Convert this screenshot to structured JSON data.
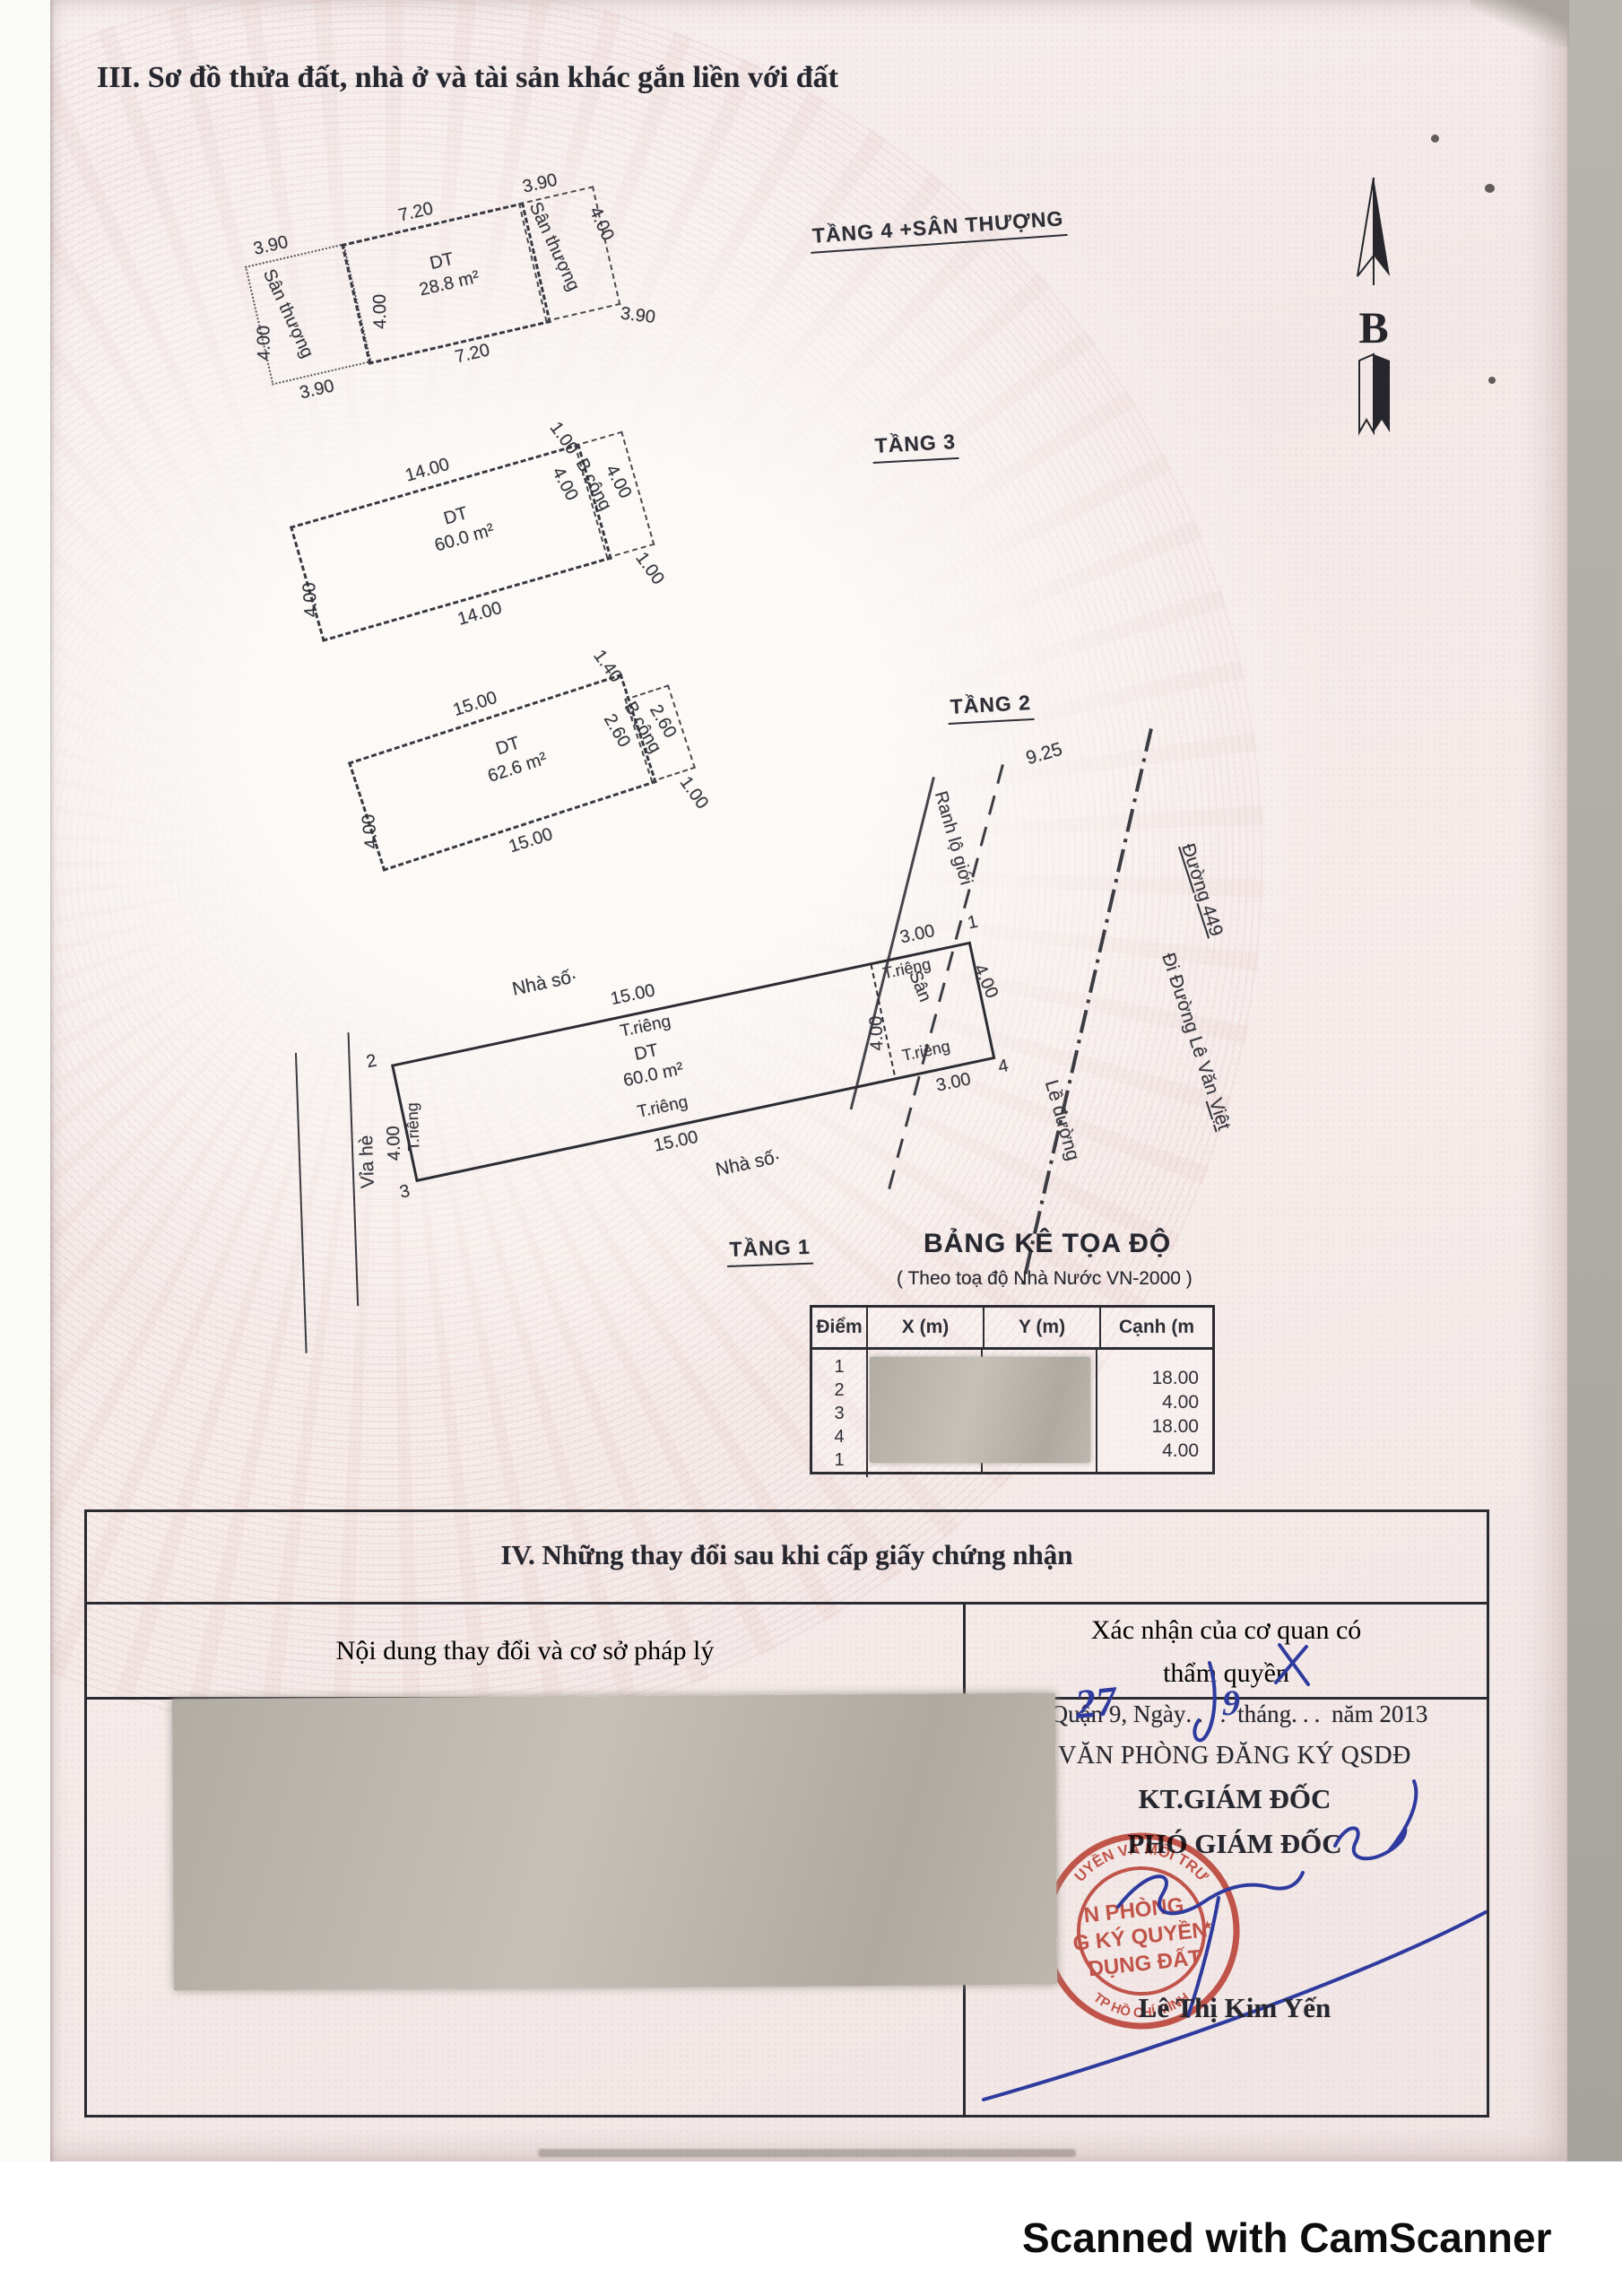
{
  "colors": {
    "stamp_red": "#c0392b",
    "pen_blue": "#2e3a9e"
  },
  "header": {
    "section_title": "III. Sơ đồ thửa đất, nhà ở và tài sản khác gắn liền với đất"
  },
  "compass": {
    "label": "B"
  },
  "plans": {
    "tang4": {
      "floor_label": "TẦNG 4 +SÂN THƯỢNG",
      "dt_label": "DT",
      "area": "28.8 m²",
      "top": "7.20",
      "bottom": "7.20",
      "divider": "4.00",
      "left_annex": {
        "name": "Sân thượng",
        "top": "3.90",
        "side": "4.00",
        "bottom": "3.90"
      },
      "right_annex": {
        "name": "Sân thượng",
        "top": "3.90",
        "side": "4.00",
        "bottom": "3.90"
      }
    },
    "tang3": {
      "floor_label": "TẦNG 3",
      "dt_label": "DT",
      "area": "60.0 m²",
      "top": "14.00",
      "bottom": "14.00",
      "left": "4.00",
      "balcony": {
        "name": "B.công",
        "inner": "4.00",
        "outer": "4.00",
        "tick_top": "1.00",
        "tick_bottom": "1.00"
      }
    },
    "tang2": {
      "floor_label": "TẦNG 2",
      "dt_label": "DT",
      "area": "62.6 m²",
      "top": "15.00",
      "bottom": "15.00",
      "left": "4.00",
      "balcony": {
        "name": "B.công",
        "inner": "2.60",
        "outer": "2.60",
        "tick_top": "1.40",
        "tick_bottom": "1.00"
      }
    },
    "tang1": {
      "floor_label": "TẦNG 1",
      "dt_label": "DT",
      "area": "60.0 m²",
      "house_no_top": "Nhà số·",
      "house_no_bottom": "Nhà số·",
      "top_len": "15.00",
      "top_type": "T.riêng",
      "bottom_type": "T.riêng",
      "bottom_len": "15.00",
      "left_type": "T.riêng",
      "left_len": "4.00",
      "sidewalk": "Vỉa hè",
      "yard": "Sân",
      "yard_top_len": "3.00",
      "yard_top_type": "T.riêng",
      "yard_bottom_type": "T.riêng",
      "yard_bottom_len": "3.00",
      "divider_len": "4.00",
      "right_len": "4.00",
      "v1": "1",
      "v2": "2",
      "v3": "3",
      "v4": "4"
    }
  },
  "roads": {
    "ranh_lo_gioi": "Ranh lộ giới",
    "le_duong": "Lề đường",
    "duong_449": "Đường 449",
    "di_duong_pre": "Đi Đường Lê Văn ",
    "di_duong_underline": "Việt",
    "dim_925": "9.25"
  },
  "coord_table": {
    "title": "BẢNG KÊ TỌA ĐỘ",
    "subtitle": "( Theo toạ độ Nhà Nước VN-2000 )",
    "headers": [
      "Điểm",
      "X (m)",
      "Y (m)",
      "Cạnh (m"
    ],
    "points": [
      "1",
      "2",
      "3",
      "4",
      "1"
    ],
    "edges": [
      "18.00",
      "4.00",
      "18.00",
      "4.00"
    ]
  },
  "section4": {
    "title": "IV. Những thay đổi sau khi cấp giấy chứng nhận",
    "col1_header": "Nội dung thay đổi và cơ sở pháp lý",
    "col2_header_line1": "Xác nhận của cơ quan có",
    "col2_header_line2": "thẩm quyền",
    "place_date_prefix": "Quận 9, Ngày",
    "date_day": "27",
    "date_thang": "tháng",
    "date_month": "9",
    "date_suffix": "năm 2013",
    "office": "VĂN PHÒNG ĐĂNG KÝ QSDĐ",
    "kt_line": "KT.GIÁM ĐỐC",
    "pho_line": "PHÓ GIÁM ĐỐC",
    "signer_name": "Lê Thị Kim Yến",
    "stamp": {
      "line1": "N PHÒNG",
      "line2": "G KÝ QUYỀN",
      "line3": "DỤNG ĐẤT",
      "ring_top": "UYỀN VÀ MÔI TRƯ",
      "ring_bottom": "TP HỒ CHÍ MINH",
      "star": "★"
    }
  },
  "footer": {
    "watermark": "Scanned with CamScanner"
  }
}
